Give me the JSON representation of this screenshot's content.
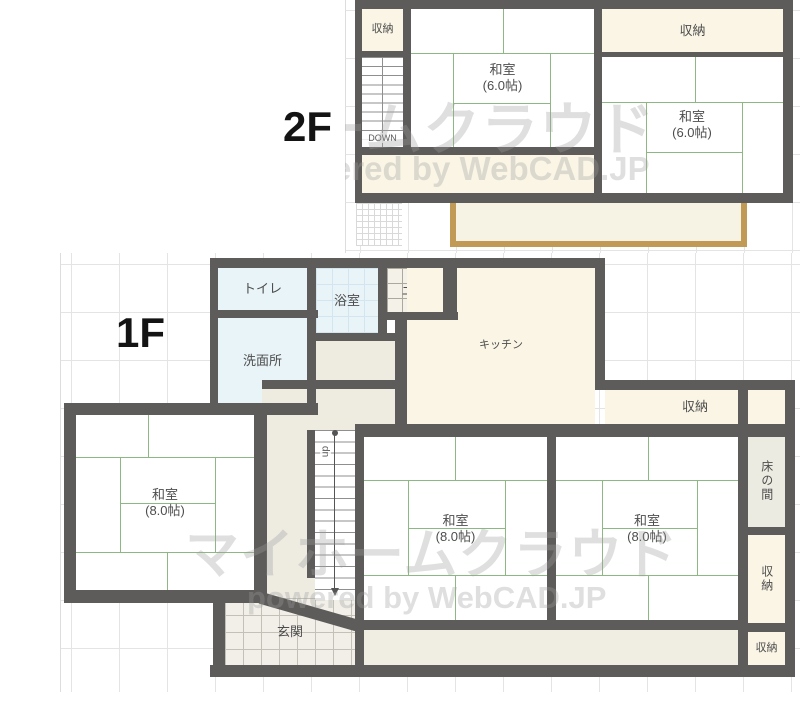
{
  "watermarks": {
    "brand": "マイホームクラウド",
    "powered_by": "powered by WebCAD.JP"
  },
  "colors": {
    "wall": "#5d5c5a",
    "tatami_line": "#8eb883",
    "water_room_blue": "#e9f4f9",
    "storage_cream": "#faf5e5",
    "hall_beige": "#eeebe1",
    "balcony_border": "#c19a56",
    "grid_line": "#e4e4e4"
  },
  "floor2": {
    "label": "2F",
    "rooms": {
      "closet_left": "収納",
      "closet_right": "収納",
      "washitsu_left_name": "和室",
      "washitsu_left_size": "(6.0帖)",
      "washitsu_right_name": "和室",
      "washitsu_right_size": "(6.0帖)",
      "stairs_down": "DOWN"
    }
  },
  "floor1": {
    "label": "1F",
    "rooms": {
      "toilet": "トイレ",
      "bath": "浴室",
      "doma": "土間",
      "washroom": "洗面所",
      "kitchen": "キッチン",
      "closet_top": "収納",
      "washitsu_left_name": "和室",
      "washitsu_left_size": "(8.0帖)",
      "washitsu_mid_name": "和室",
      "washitsu_mid_size": "(8.0帖)",
      "washitsu_right_name": "和室",
      "washitsu_right_size": "(8.0帖)",
      "tokonoma": "床の間",
      "closet_mid": "収納",
      "closet_bottom": "収納",
      "entrance": "玄関",
      "stairs_up": "up"
    }
  }
}
